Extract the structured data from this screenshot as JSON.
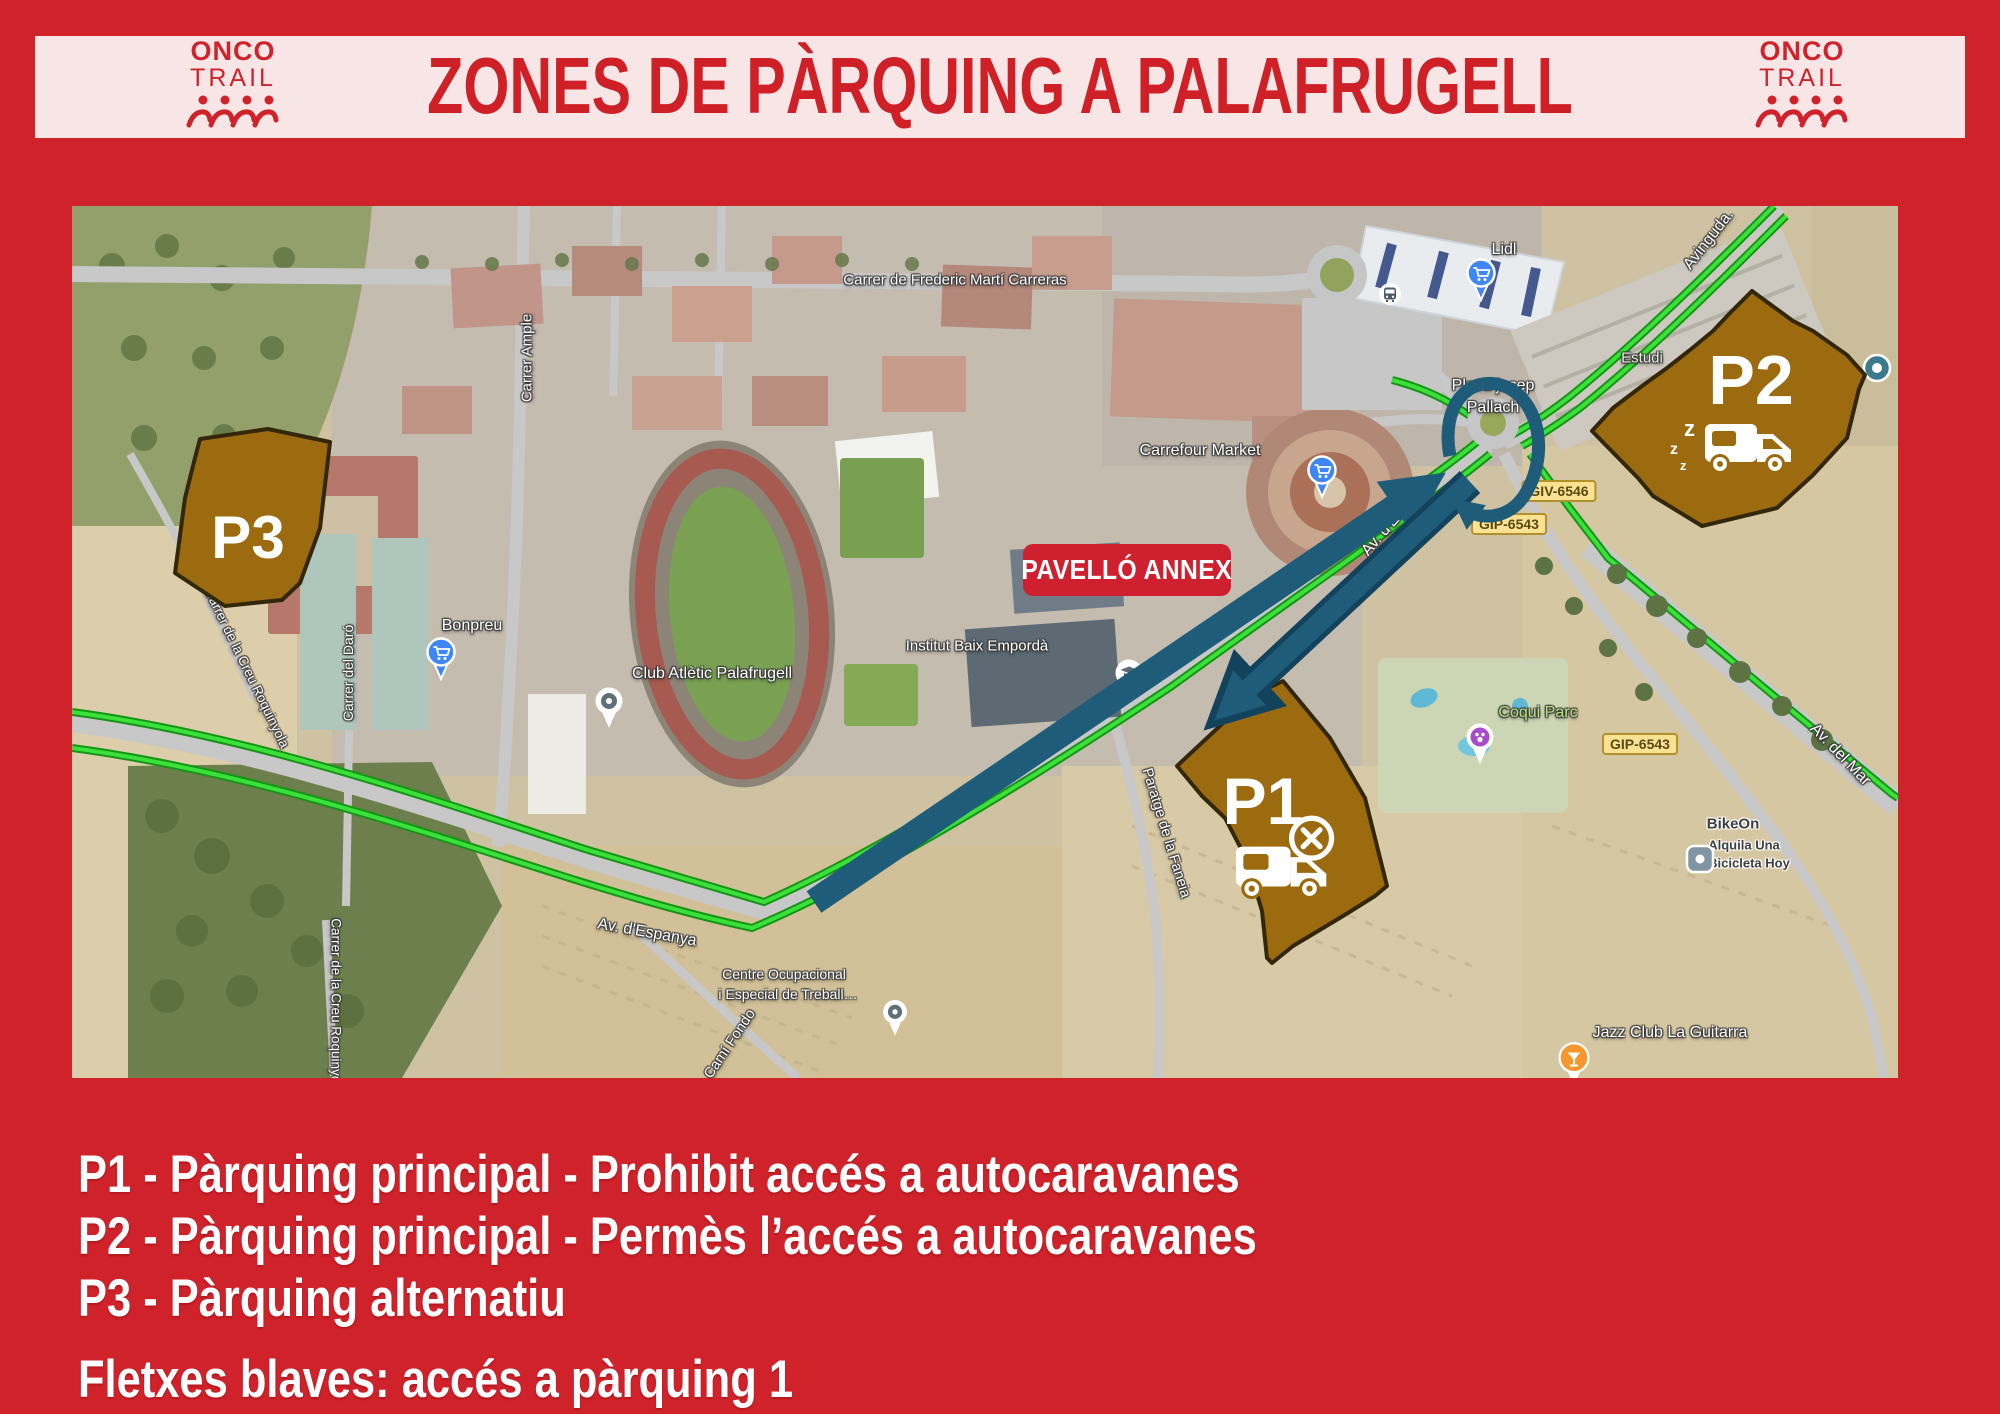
{
  "header": {
    "title": "ZONES DE PÀRQUING A PALAFRUGELL",
    "logo_left": {
      "line1": "ONCO",
      "line2": "TRAIL"
    },
    "logo_right": {
      "line1": "ONCO",
      "line2": "TRAIL"
    }
  },
  "legend": {
    "line1": "P1 - Pàrquing principal - Prohibit accés a autocaravanes",
    "line2": "P2 - Pàrquing principal - Permès l’accés a autocaravanes",
    "line3": "P3 - Pàrquing alternatiu",
    "note": "Fletxes blaves: accés a pàrquing 1"
  },
  "zones": {
    "p1": "P1",
    "p2": "P2",
    "p3": "P3",
    "zzz": "z"
  },
  "annex_label": "PAVELLÓ ANNEX",
  "roads": {
    "frederic": "Carrer de Frederic Martí Carreras",
    "ample": "Carrer Ample",
    "daro": "Carrer del Daró",
    "roquinyola_a": "Carrer de la Creu Roquinyola",
    "roquinyola_b": "Carrer de la Creu Roquinyola",
    "espanya_west": "Av. d'Espanya",
    "espanya_diag": "Av. d'Espanya",
    "paratge": "Paratge de la Faneia",
    "cami_fondo": "Camí Fondo",
    "avinguda": "Avinguda.",
    "av_del_mar": "Av. del Mar"
  },
  "pois": {
    "lidl": "Lidl",
    "carrefour": "Carrefour Market",
    "placa_line1": "Placa josep",
    "placa_line2": "Pallach",
    "estudi": "Estudi",
    "institut": "Institut Baix Empordà",
    "bonpreu": "Bonpreu",
    "club": "Club Atlètic Palafrugell",
    "centre_line1": "Centre Ocupacional",
    "centre_line2": "i Especial de Treball…",
    "coqui": "Coqui Parc",
    "bikeon": "BikeOn",
    "bikeon_sub1": "Alquila Una",
    "bikeon_sub2": "Bicicleta Hoy",
    "jazz": "Jazz Club La Guitarra"
  },
  "badges": {
    "giv": "GIV-6546",
    "gip_a": "GIP-6543",
    "gip_b": "GIP-6543"
  },
  "colors": {
    "background_red": "#d0222b",
    "banner_pink": "#f8e6e6",
    "title_red": "#cf2027",
    "zone_brown": "#9c6b10",
    "zone_outline": "#33270a",
    "arrow_blue": "#1e5c7a",
    "route_green": "#3be03b",
    "badge_yellow": "#fbe293",
    "annex_red": "#cf2030"
  }
}
